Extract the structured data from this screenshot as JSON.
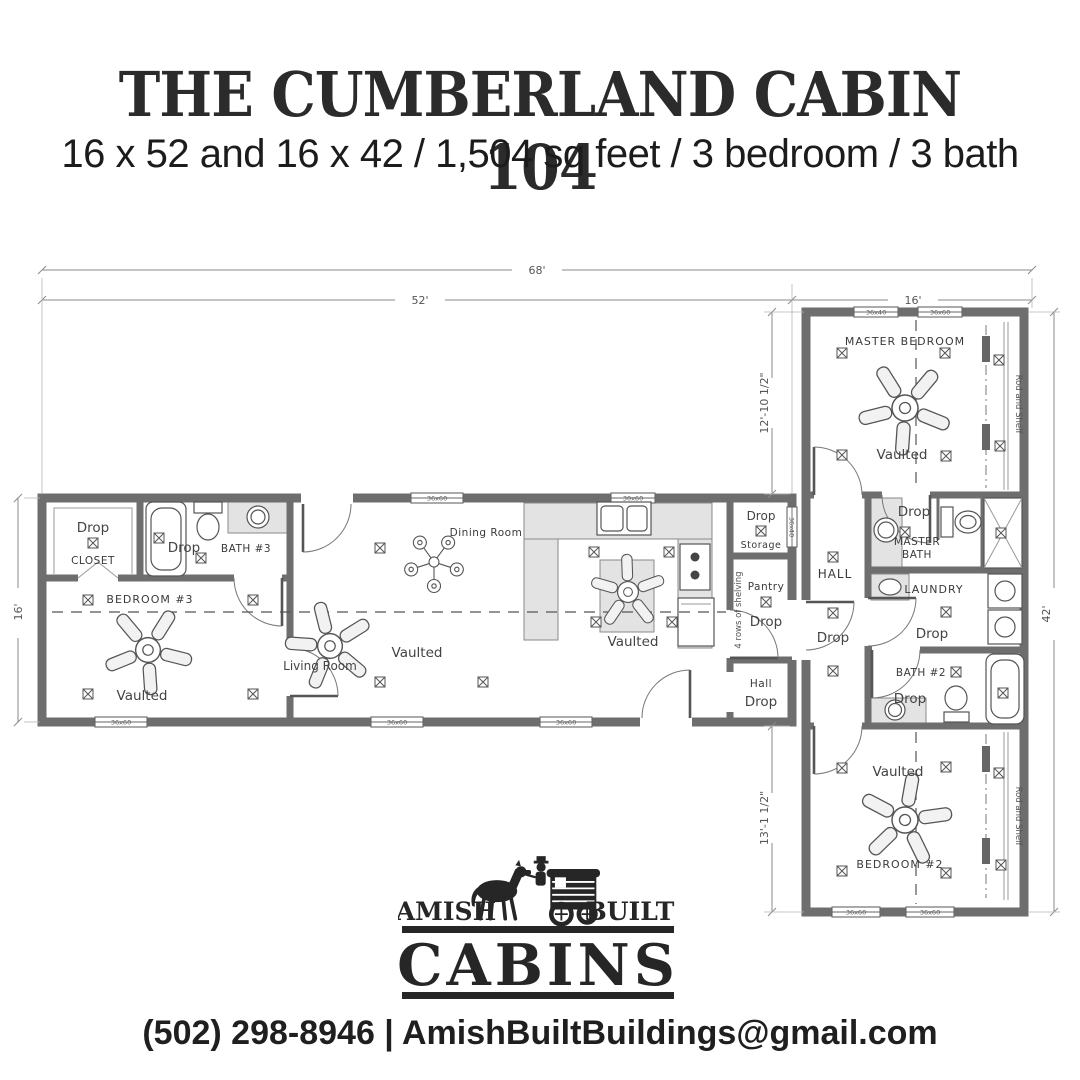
{
  "header": {
    "title": "THE CUMBERLAND CABIN 104",
    "subtitle": "16 x 52 and 16 x 42 / 1,504 sq feet / 3 bedroom / 3 bath"
  },
  "dimensions": {
    "overall_width": "68'",
    "main_width": "52'",
    "wing_width": "16'",
    "main_depth": "16'",
    "wing_upper_depth": "12'-10 1/2\"",
    "wing_lower_depth": "13'-1 1/2\"",
    "wing_depth": "42'"
  },
  "rooms": {
    "closet": {
      "drop": "Drop",
      "name": "CLOSET"
    },
    "bath3": {
      "drop": "Drop",
      "name": "BATH #3"
    },
    "bedroom3": {
      "name": "BEDROOM #3",
      "ceiling": "Vaulted"
    },
    "living": {
      "name": "Living Room",
      "ceiling": "Vaulted"
    },
    "dining": {
      "name": "Dining Room"
    },
    "kitchen": {
      "ceiling": "Vaulted"
    },
    "storage": {
      "drop": "Drop",
      "name": "Storage"
    },
    "pantry": {
      "name": "Pantry",
      "drop": "Drop",
      "shelving": "4 rows of shelving"
    },
    "hall_main": {
      "name": "Hall",
      "drop": "Drop"
    },
    "hall_wing": {
      "name": "HALL",
      "drop": "Drop"
    },
    "master_bedroom": {
      "name": "MASTER BEDROOM",
      "ceiling": "Vaulted",
      "rod": "Rod and Shelf"
    },
    "master_bath": {
      "line1": "MASTER",
      "line2": "BATH",
      "drop": "Drop"
    },
    "laundry": {
      "name": "LAUNDRY",
      "drop": "Drop"
    },
    "bath2": {
      "name": "BATH #2",
      "drop": "Drop"
    },
    "bedroom2": {
      "name": "BEDROOM #2",
      "ceiling": "Vaulted",
      "rod": "Rod and Shelf"
    }
  },
  "windows": {
    "large": "36x60",
    "small": "36x40",
    "kitchen": "30x60"
  },
  "logo": {
    "top_left": "AMISH",
    "top_right": "BUILT",
    "main": "CABINS"
  },
  "footer": {
    "contact": "(502) 298-8946 | AmishBuiltBuildings@gmail.com"
  }
}
